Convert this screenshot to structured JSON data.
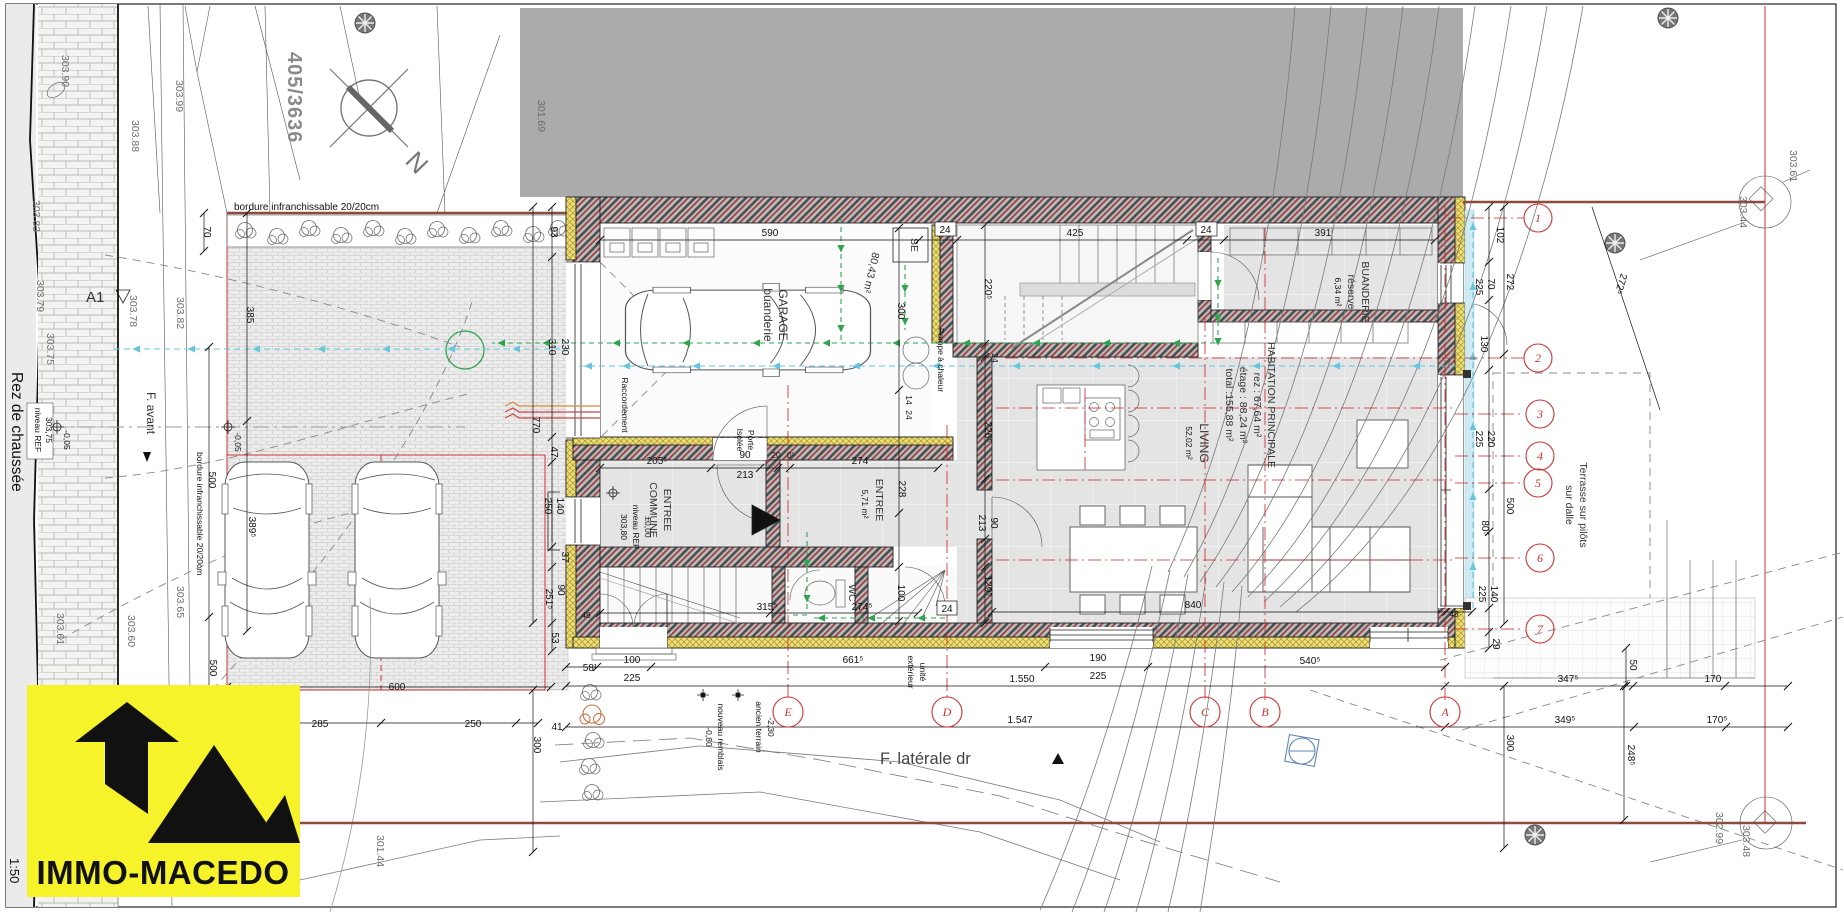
{
  "sheet": {
    "floor_title": "Rez de chaussée",
    "scale": "1:50",
    "parcel": "405/3636",
    "north_letter": "N",
    "section_a1": "A1"
  },
  "logo": {
    "brand": "IMMO-MACEDO"
  },
  "rooms": {
    "garage_l1": "GARAGE",
    "garage_l2": "buanderie",
    "garage_area": "80,43 m²",
    "entree_commune_l1": "ENTREE",
    "entree_commune_l2": "COMMUNE",
    "niveau_l1": "±0,00",
    "niveau_l2": "niveau REF",
    "niveau_l3": "303,80",
    "entree_l1": "ENTREE",
    "entree_l2": "5,71 m²",
    "wc": "WC",
    "buanderie_l1": "BUANDERIE",
    "buanderie_l2": "réserve",
    "buanderie_l3": "6,34 m²",
    "habitation_l1": "HABITATION PRINCIPALE",
    "habitation_l2": "rez : 67,64 m²",
    "habitation_l3": "étage : 88,24 m²",
    "habitation_l4": "total :155,88 m²",
    "living_l1": "LIVING",
    "living_l2": "52,02 m²",
    "pompe": "Pompe à chaleur",
    "porte_isolee_l1": "Porte",
    "porte_isolee_l2": "Isolée",
    "se": "SE",
    "raccordement": "Raccordement",
    "terrasse_l1": "Terrasse sur pilôts",
    "terrasse_l2": "sur dalle",
    "unite_l1": "unité",
    "unite_l2": "extérieur"
  },
  "site": {
    "bordure_top": "bordure infranchissable 20/20cm",
    "bordure_left": "bordure infranchissable 20/20cm",
    "f_avant": "F. avant",
    "f_laterale": "F. latérale dr",
    "niveau_ref_l1": "niveau REF",
    "niveau_ref_l2": "303,75",
    "minus_005_street": "-0,05",
    "minus_005_drive": "-0,05",
    "ancien_l1": "ancien terrain",
    "ancien_l2": "-2,30",
    "remblais_l1": "-0,80",
    "remblais_l2": "nouveau remblais"
  },
  "axes": {
    "letters": [
      "E",
      "D",
      "C",
      "B",
      "A"
    ],
    "numbers": [
      "1",
      "2",
      "3",
      "4",
      "5",
      "6",
      "7"
    ]
  },
  "elev": [
    "303.90",
    "303.99",
    "303.88",
    "303.83",
    "303.79",
    "303.75",
    "303.78",
    "303.82",
    "301.69",
    "303.65",
    "303.60",
    "303.61",
    "301.44",
    "303.61",
    "303.44",
    "302.99",
    "303.48"
  ],
  "dims": [
    "70",
    "385",
    "500",
    "389⁵",
    "500",
    "600",
    "285",
    "250",
    "41",
    "300",
    "93",
    "310",
    "230",
    "770",
    "47",
    "140",
    "250",
    "37",
    "90",
    "251⁵",
    "53",
    "48",
    "58¹",
    "100",
    "225",
    "661⁵",
    "190",
    "225",
    "540⁵",
    "1.550",
    "1.547",
    "590",
    "425",
    "391",
    "24",
    "24",
    "220⁵",
    "300",
    "226⁵",
    "90",
    "213",
    "129⁵",
    "205⁵",
    "90",
    "213",
    "20",
    "0⁵",
    "274",
    "228",
    "14",
    "24",
    "24",
    "315⁵",
    "274⁵",
    "24",
    "100",
    "102",
    "272",
    "70",
    "225",
    "130",
    "220",
    "225",
    "500",
    "80⁵",
    "140",
    "225",
    "29",
    "48",
    "347⁵",
    "170",
    "349⁵",
    "170⁵",
    "50",
    "248⁵",
    "300",
    "272⁵",
    "840"
  ]
}
